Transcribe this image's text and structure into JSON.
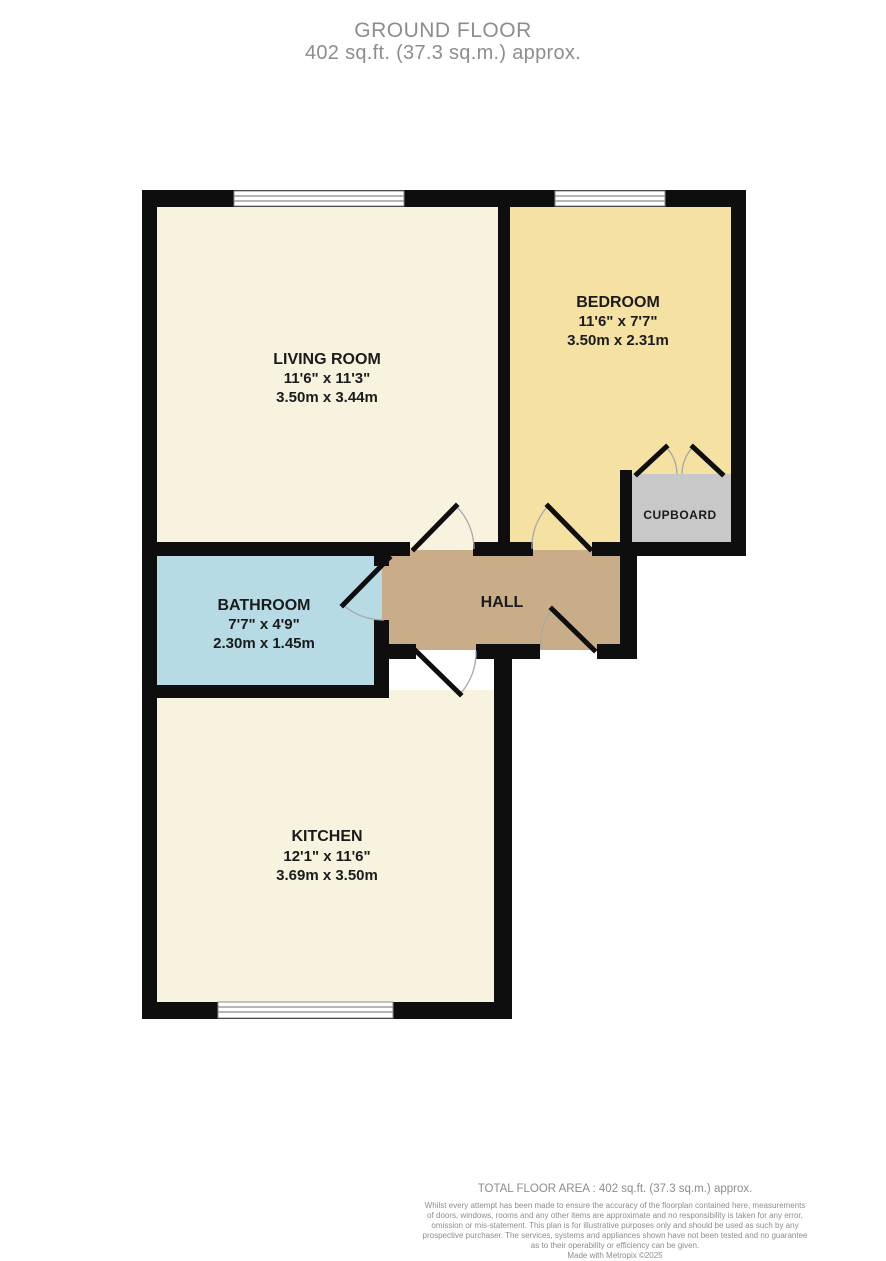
{
  "header": {
    "title": "GROUND FLOOR",
    "subtitle": "402 sq.ft. (37.3 sq.m.) approx."
  },
  "rooms": {
    "living": {
      "name": "LIVING ROOM",
      "dims_imperial": "11'6\" x 11'3\"",
      "dims_metric": "3.50m x 3.44m"
    },
    "bedroom": {
      "name": "BEDROOM",
      "dims_imperial": "11'6\" x 7'7\"",
      "dims_metric": "3.50m x 2.31m"
    },
    "bathroom": {
      "name": "BATHROOM",
      "dims_imperial": "7'7\" x 4'9\"",
      "dims_metric": "2.30m x 1.45m"
    },
    "kitchen": {
      "name": "KITCHEN",
      "dims_imperial": "12'1\" x 11'6\"",
      "dims_metric": "3.69m x 3.50m"
    },
    "hall": {
      "name": "HALL"
    },
    "cupboard": {
      "name": "CUPBOARD"
    }
  },
  "footer": {
    "total_area": "TOTAL FLOOR AREA : 402 sq.ft. (37.3 sq.m.) approx.",
    "disclaimer_lines": [
      "Whilst every attempt has been made to ensure the accuracy of the floorplan contained here, measurements",
      "of doors, windows, rooms and any other items are approximate and no responsibility is taken for any error,",
      "omission or mis-statement. This plan is for illustrative purposes only and should be used as such by any",
      "prospective purchaser. The services, systems and appliances shown have not been tested and no guarantee",
      "as to their operability or efficiency can be given.",
      "Made with Metropix ©2025"
    ]
  },
  "colors": {
    "wall": "#0e0e0e",
    "living_fill": "#f8f3de",
    "kitchen_fill": "#f8f3de",
    "bedroom_fill": "#f5e2a3",
    "hall_fill": "#c9ad88",
    "bathroom_fill": "#b7dbe5",
    "cupboard_fill": "#c8c8c8",
    "muted_text": "#8d8d8d"
  }
}
